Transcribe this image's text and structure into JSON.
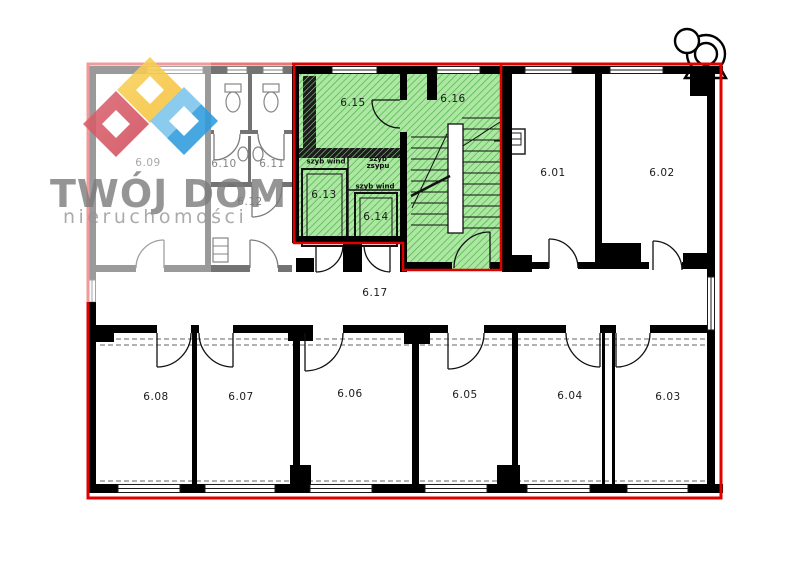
{
  "page": {
    "width": 800,
    "height": 575,
    "background": "#ffffff"
  },
  "logo": {
    "line1": "TWÓJ DOM",
    "line2": "nieruchomości",
    "text_color": "#7a7a7a",
    "subtext_color": "#949494",
    "diamond_red": "#d85a65",
    "diamond_yellow": "#f8c844",
    "diamond_blue_light": "#7cc4eb",
    "diamond_blue_dark": "#2e9cde"
  },
  "floor_plan": {
    "outline_color": "#e10000",
    "wall_color": "#000000",
    "highlight_fill": "#ace8a3",
    "highlight_hatch": "#54b54a",
    "room_labels": [
      {
        "id": "6.01",
        "x": 553,
        "y": 173
      },
      {
        "id": "6.02",
        "x": 662,
        "y": 173
      },
      {
        "id": "6.03",
        "x": 668,
        "y": 397
      },
      {
        "id": "6.04",
        "x": 570,
        "y": 396
      },
      {
        "id": "6.05",
        "x": 465,
        "y": 395
      },
      {
        "id": "6.06",
        "x": 350,
        "y": 394
      },
      {
        "id": "6.07",
        "x": 241,
        "y": 397
      },
      {
        "id": "6.08",
        "x": 156,
        "y": 397
      },
      {
        "id": "6.09",
        "x": 148,
        "y": 163
      },
      {
        "id": "6.10",
        "x": 224,
        "y": 164
      },
      {
        "id": "6.11",
        "x": 272,
        "y": 164
      },
      {
        "id": "6.12",
        "x": 250,
        "y": 202
      },
      {
        "id": "6.13",
        "x": 324,
        "y": 195
      },
      {
        "id": "6.14",
        "x": 376,
        "y": 217
      },
      {
        "id": "6.15",
        "x": 353,
        "y": 103
      },
      {
        "id": "6.16",
        "x": 453,
        "y": 99
      },
      {
        "id": "6.17",
        "x": 375,
        "y": 293
      }
    ],
    "shaft_labels": [
      {
        "lines": [
          "szyb wind"
        ],
        "x": 326,
        "y": 162
      },
      {
        "lines": [
          "szyb",
          "zsypu"
        ],
        "x": 378,
        "y": 163
      },
      {
        "lines": [
          "szyb wind"
        ],
        "x": 375,
        "y": 187
      }
    ]
  }
}
